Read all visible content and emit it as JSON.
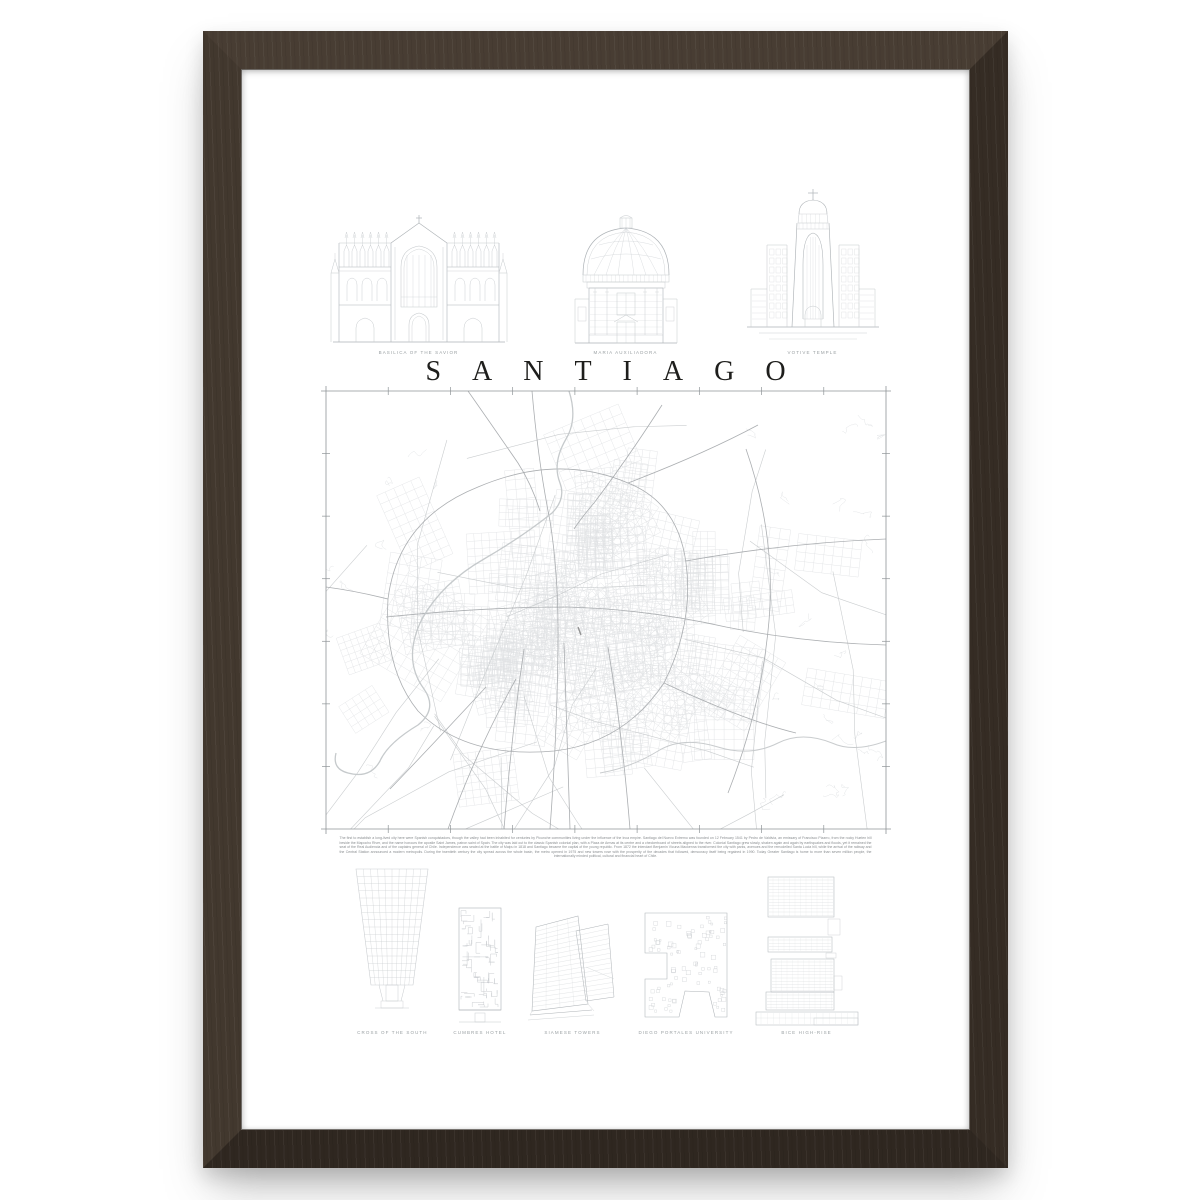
{
  "poster": {
    "title": "SANTIAGO",
    "top_buildings": [
      {
        "id": "basilica-of-the-savior",
        "caption": "BASILICA OF THE SAVIOR"
      },
      {
        "id": "maria-auxiliadora",
        "caption": "MARIA AUXILIADORA"
      },
      {
        "id": "votive-temple",
        "caption": "VOTIVE TEMPLE"
      }
    ],
    "bottom_buildings": [
      {
        "id": "cross-of-the-south",
        "caption": "CROSS OF THE SOUTH"
      },
      {
        "id": "cumbres-hotel",
        "caption": "CUMBRES HOTEL"
      },
      {
        "id": "siamese-towers",
        "caption": "SIAMESE TOWERS"
      },
      {
        "id": "diego-portales-university",
        "caption": "DIEGO PORTALES UNIVERSITY"
      },
      {
        "id": "bice-high-rise",
        "caption": "BICE HIGH-RISE"
      }
    ],
    "description": "The first to establish a long-lived city here were Spanish conquistadors, though the valley had been inhabited for centuries by Picunche communities living under the influence of the Inca empire. Santiago del Nuevo Extremo was founded on 12 February 1541 by Pedro de Valdivia, an emissary of Francisco Pizarro, from the rocky Huelen hill beside the Mapocho River, and the name honours the apostle Saint James, patron saint of Spain. The city was laid out to the classic Spanish colonial plan, with a Plaza de Armas at its centre and a checkerboard of streets aligned to the river. Colonial Santiago grew slowly, shaken again and again by earthquakes and floods, yet it remained the seat of the Real Audiencia and of the captains general of Chile. Independence was sealed at the battle of Maipu in 1818 and Santiago became the capital of the young republic. From 1872 the intendant Benjamin Vicuna Mackenna transformed the city with parks, avenues and the remodelled Santa Lucia hill, while the arrival of the railway and the Central Station announced a modern metropolis. During the twentieth century the city spread across the whole basin, the metro opened in 1975 and new towers rose with the prosperity of the decades that followed, democracy itself being regained in 1990. Today Greater Santiago is home to more than seven million people, the internationally minded political, cultural and financial heart of Chile.",
    "colors": {
      "frame_wood": "#3a3028",
      "line_art": "#c6cacd",
      "line_art_strong": "#aeb3b7",
      "map_minor_street": "#e0e2e4",
      "map_mid_street": "#c4c8ca",
      "map_major_road": "#a6aaad",
      "map_river": "#c3c7c9",
      "map_border": "#8f9497",
      "title_color": "#1e1e1c",
      "caption_color": "#9aa0a3",
      "paragraph_color": "#8a8e91"
    }
  }
}
